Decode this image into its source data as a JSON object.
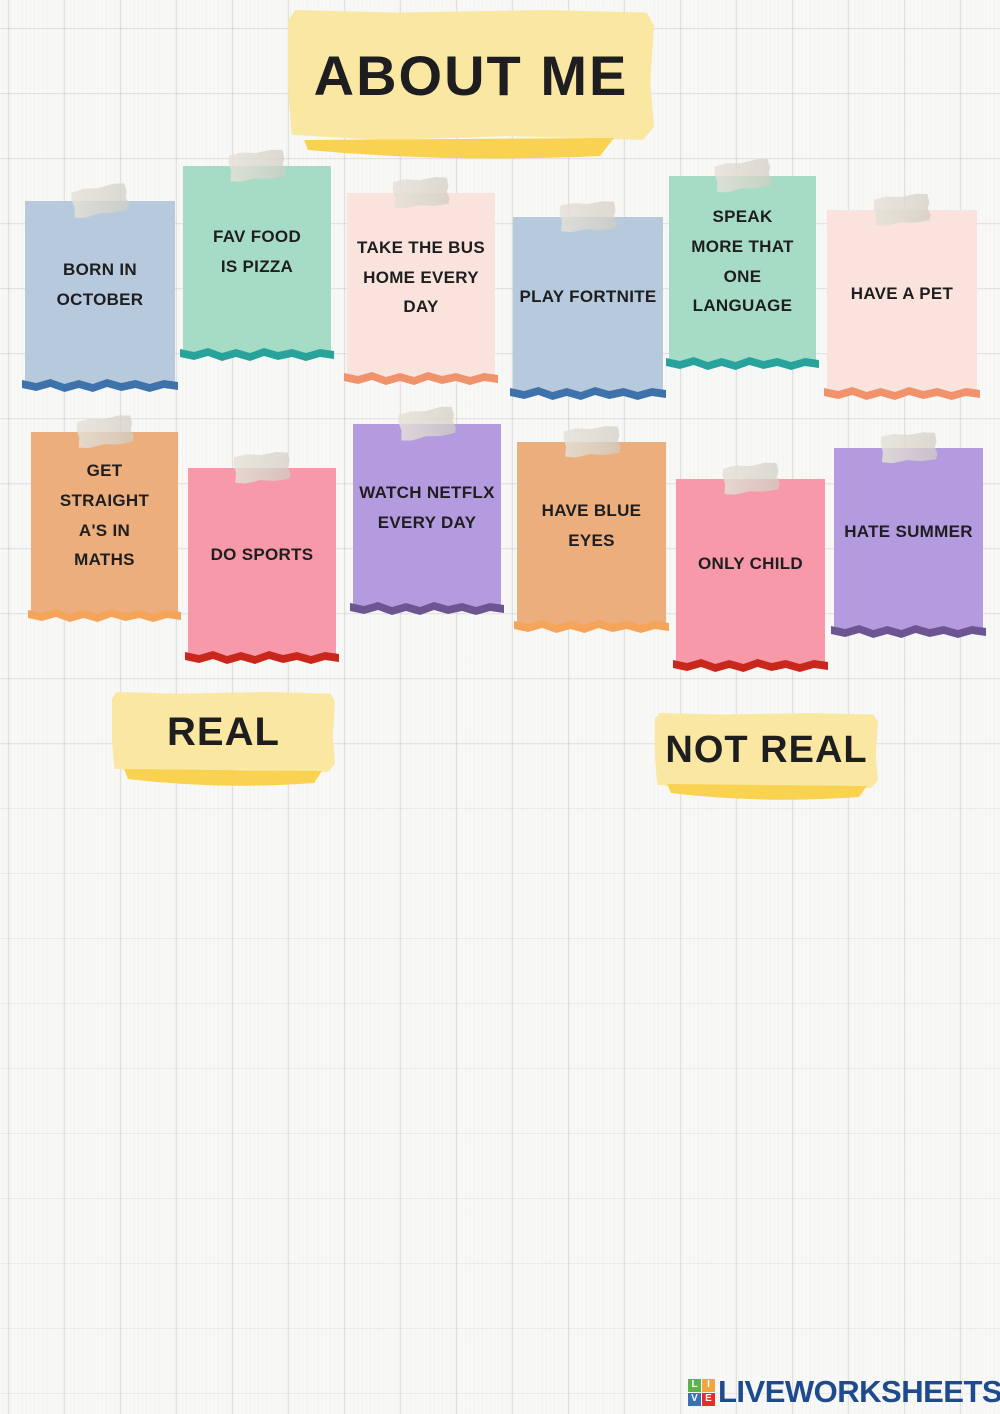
{
  "title": "ABOUT ME",
  "categories": {
    "real": "REAL",
    "not_real": "NOT REAL"
  },
  "notes": [
    {
      "text": "BORN IN\nOCTOBER",
      "paper_color": "#b7c9dc",
      "edge_color": "#3e72ab"
    },
    {
      "text": "FAV FOOD\nIS PIZZA",
      "paper_color": "#a6dcc6",
      "edge_color": "#28a39b"
    },
    {
      "text": "TAKE THE BUS\nHOME EVERY\nDAY",
      "paper_color": "#f9e3dc",
      "edge_color": "#f0926b"
    },
    {
      "text": "PLAY  FORTNITE",
      "paper_color": "#b7c9dc",
      "edge_color": "#3e72ab"
    },
    {
      "text": "SPEAK\nMORE THAT\nONE\nLANGUAGE",
      "paper_color": "#a6dcc6",
      "edge_color": "#28a39b"
    },
    {
      "text": "HAVE A PET",
      "paper_color": "#f9e3dc",
      "edge_color": "#f0926b"
    },
    {
      "text": "GET\nSTRAIGHT\nA'S IN\nMATHS",
      "paper_color": "#ecae7d",
      "edge_color": "#f5a55a"
    },
    {
      "text": "DO SPORTS",
      "paper_color": "#f799a8",
      "edge_color": "#c9271c"
    },
    {
      "text": "WATCH NETFLX\nEVERY DAY",
      "paper_color": "#b49bdf",
      "edge_color": "#6d5591"
    },
    {
      "text": "HAVE BLUE EYES",
      "paper_color": "#ecae7d",
      "edge_color": "#f5a55a"
    },
    {
      "text": "ONLY CHILD",
      "paper_color": "#f799a8",
      "edge_color": "#c9271c"
    },
    {
      "text": "HATE SUMMER",
      "paper_color": "#b49bdf",
      "edge_color": "#6d5591"
    }
  ],
  "footer": {
    "brand": "LIVEWORKSHEETS",
    "logo_letters": [
      "L",
      "I",
      "V",
      "E"
    ],
    "logo_colors": {
      "L": "#5cb348",
      "I": "#f2a53b",
      "V": "#3b6fb6",
      "E": "#e12f2f"
    },
    "brand_color": "#1d4b8e"
  },
  "palette": {
    "background": "#f8f8f6",
    "banner_yellow": "#fae8a2",
    "banner_strip_yellow": "#f9d251",
    "text_color": "#1e1e20"
  }
}
